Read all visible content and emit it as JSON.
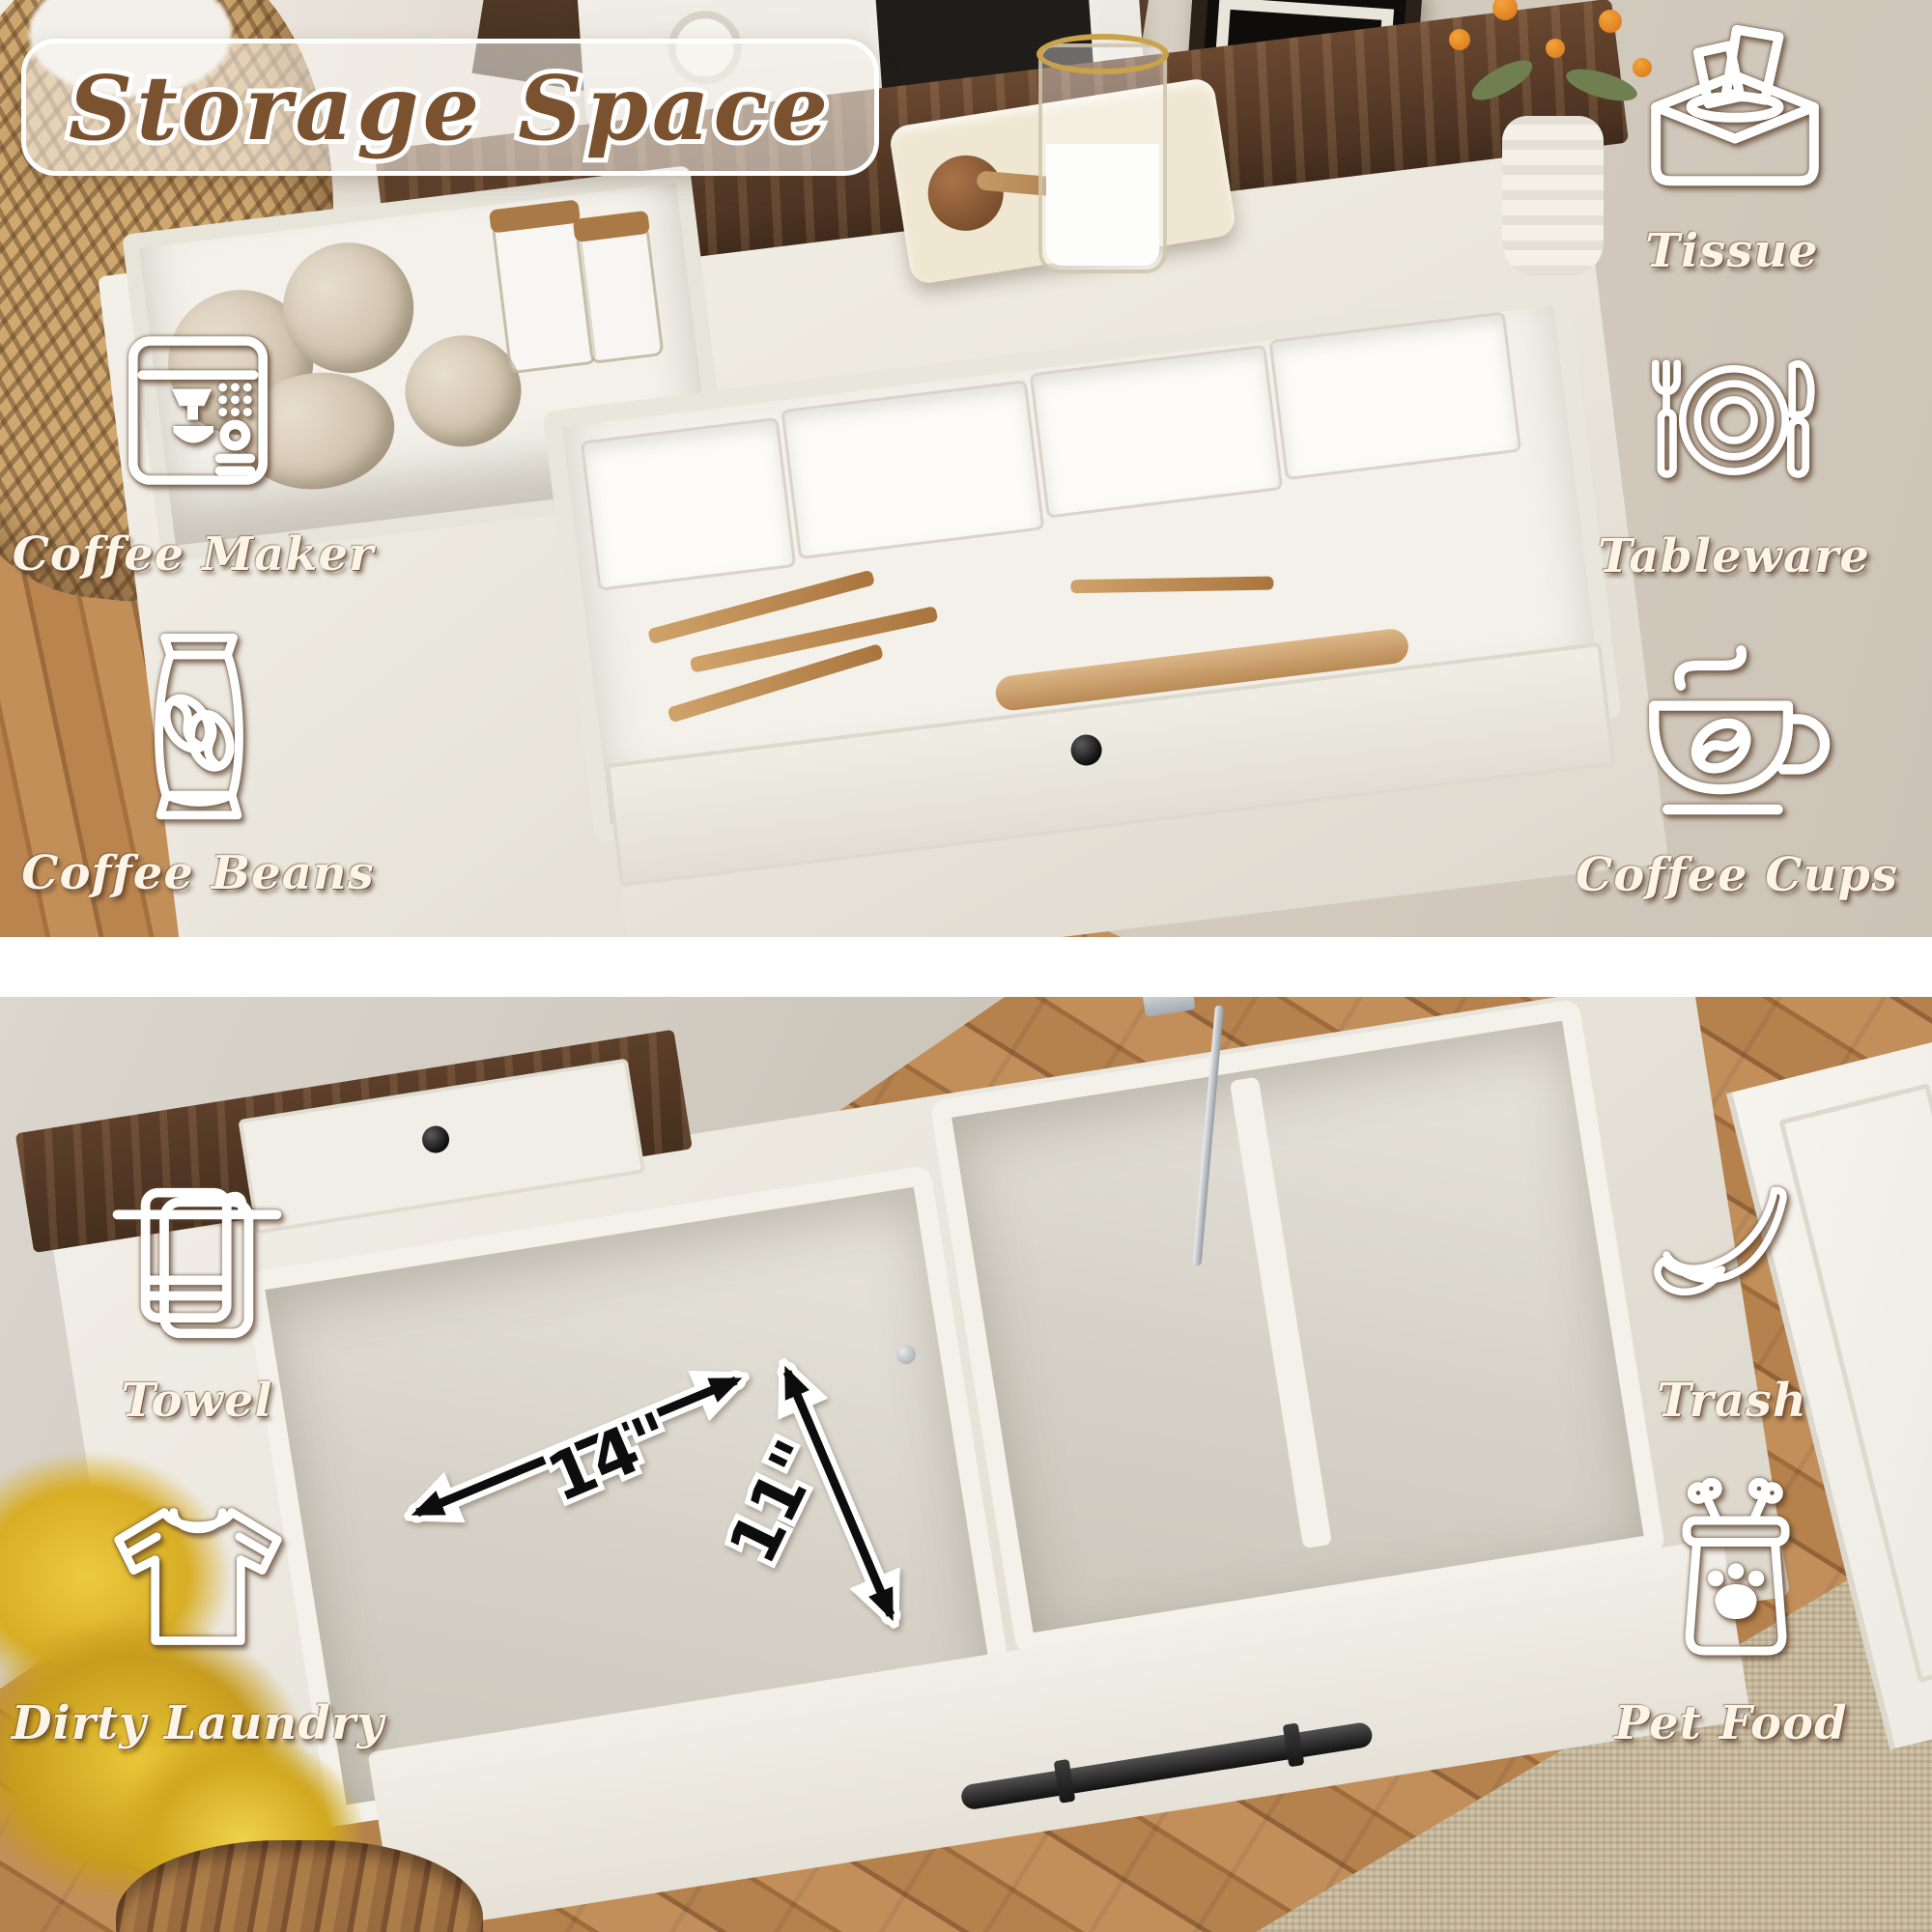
{
  "title": "Storage Space",
  "top_panel": {
    "labels": {
      "coffee_maker": "Coffee Maker",
      "coffee_beans": "Coffee Beans",
      "tissue": "Tissue",
      "tableware": "Tableware",
      "coffee_cups": "Coffee Cups"
    },
    "icons": [
      "coffee-maker-icon",
      "coffee-beans-icon",
      "tissue-box-icon",
      "tableware-icon",
      "coffee-cup-icon"
    ]
  },
  "bottom_panel": {
    "labels": {
      "towel": "Towel",
      "dirty_laundry": "Dirty Laundry",
      "trash": "Trash",
      "pet_food": "Pet Food"
    },
    "icons": [
      "towel-icon",
      "tshirt-icon",
      "banana-peel-icon",
      "pet-food-icon"
    ],
    "dimensions": {
      "width": "14\"",
      "height": "11\""
    }
  },
  "colors": {
    "title_text": "#7b5230",
    "title_outline": "#ffffff",
    "label_text": "#fbf4e7",
    "label_outline": "#6b4a33",
    "dimension_text": "#0d0d0d",
    "wood_counter": "#54382a",
    "cabinet_white": "#efece4",
    "floor_wood": "#b5814d"
  }
}
